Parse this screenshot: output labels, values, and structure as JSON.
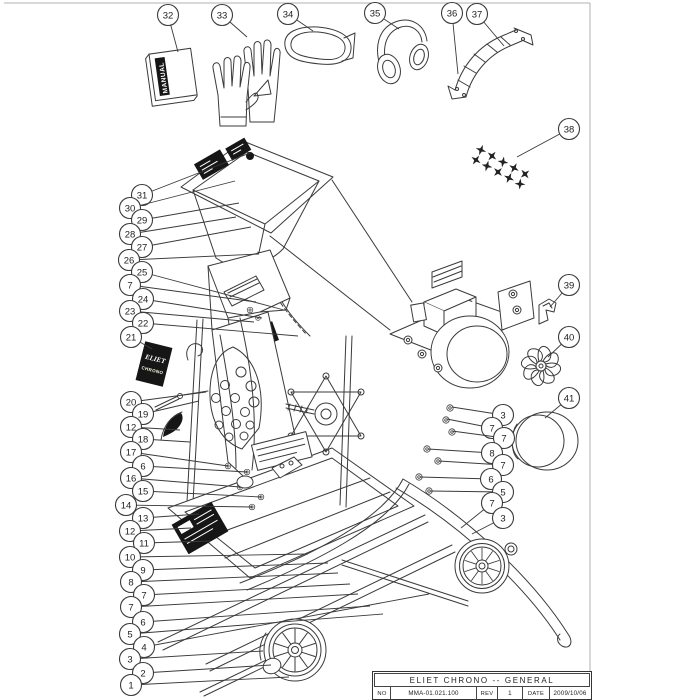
{
  "colors": {
    "line": "#3a3a3a",
    "highlight_yellow": "#f0d81e",
    "decal_black": "#161616",
    "background": "#ffffff",
    "frame_gray": "#b0b0b0"
  },
  "labels": {
    "manual": "MANUAL",
    "brand_line1": "ELIET",
    "brand_line2": "CHRONO"
  },
  "title_block": {
    "title": "ELIET CHRONO -- GENERAL",
    "no_label": "NO",
    "no_value": "MMA-01.021.100",
    "rev_label": "REV",
    "rev_value": "1",
    "date_label": "DATE",
    "date_value": "2009/10/06"
  },
  "callouts": [
    {
      "n": "32",
      "x": 168,
      "y": 15,
      "tx": 178,
      "ty": 52
    },
    {
      "n": "33",
      "x": 222,
      "y": 15,
      "tx": 247,
      "ty": 37
    },
    {
      "n": "34",
      "x": 288,
      "y": 14,
      "tx": 313,
      "ty": 31
    },
    {
      "n": "35",
      "x": 375,
      "y": 13,
      "tx": 399,
      "ty": 29
    },
    {
      "n": "36",
      "x": 452,
      "y": 13,
      "tx": 458,
      "ty": 74
    },
    {
      "n": "37",
      "x": 477,
      "y": 14,
      "tx": 504,
      "ty": 46
    },
    {
      "n": "38",
      "x": 569,
      "y": 129,
      "tx": 517,
      "ty": 157
    },
    {
      "n": "39",
      "x": 569,
      "y": 285,
      "tx": 550,
      "ty": 307
    },
    {
      "n": "40",
      "x": 569,
      "y": 337,
      "tx": 548,
      "ty": 357
    },
    {
      "n": "41",
      "x": 569,
      "y": 398,
      "tx": 545,
      "ty": 418
    },
    {
      "n": "31",
      "x": 142,
      "y": 195,
      "tx": 250,
      "ty": 153
    },
    {
      "n": "30",
      "x": 130,
      "y": 208,
      "tx": 235,
      "ty": 181
    },
    {
      "n": "29",
      "x": 142,
      "y": 220,
      "tx": 239,
      "ty": 203
    },
    {
      "n": "28",
      "x": 130,
      "y": 234,
      "tx": 236,
      "ty": 217
    },
    {
      "n": "27",
      "x": 142,
      "y": 247,
      "tx": 251,
      "ty": 227
    },
    {
      "n": "26",
      "x": 129,
      "y": 260,
      "tx": 259,
      "ty": 254
    },
    {
      "n": "25",
      "x": 142,
      "y": 272,
      "tx": 284,
      "ty": 310
    },
    {
      "n": "7",
      "x": 130,
      "y": 285,
      "tx": 256,
      "ty": 302
    },
    {
      "n": "24",
      "x": 143,
      "y": 299,
      "tx": 262,
      "ty": 318
    },
    {
      "n": "23",
      "x": 130,
      "y": 311,
      "tx": 254,
      "ty": 322
    },
    {
      "n": "22",
      "x": 143,
      "y": 323,
      "tx": 298,
      "ty": 336
    },
    {
      "n": "21",
      "x": 131,
      "y": 337,
      "tx": 152,
      "ty": 349
    },
    {
      "n": "20",
      "x": 131,
      "y": 402,
      "tx": 206,
      "ty": 392
    },
    {
      "n": "19",
      "x": 143,
      "y": 414,
      "tx": 199,
      "ty": 401
    },
    {
      "n": "12",
      "x": 131,
      "y": 427,
      "tx": 180,
      "ty": 430
    },
    {
      "n": "18",
      "x": 143,
      "y": 439,
      "tx": 190,
      "ty": 442
    },
    {
      "n": "17",
      "x": 131,
      "y": 452,
      "tx": 228,
      "ty": 466
    },
    {
      "n": "6",
      "x": 143,
      "y": 466,
      "tx": 247,
      "ty": 472
    },
    {
      "n": "16",
      "x": 131,
      "y": 478,
      "tx": 240,
      "ty": 487
    },
    {
      "n": "15",
      "x": 143,
      "y": 491,
      "tx": 261,
      "ty": 497
    },
    {
      "n": "14",
      "x": 126,
      "y": 505,
      "tx": 252,
      "ty": 507
    },
    {
      "n": "13",
      "x": 143,
      "y": 518,
      "tx": 199,
      "ty": 514
    },
    {
      "n": "12",
      "x": 130,
      "y": 531,
      "tx": 191,
      "ty": 528
    },
    {
      "n": "11",
      "x": 144,
      "y": 543,
      "tx": 211,
      "ty": 541
    },
    {
      "n": "10",
      "x": 130,
      "y": 557,
      "tx": 308,
      "ty": 554
    },
    {
      "n": "9",
      "x": 143,
      "y": 570,
      "tx": 328,
      "ty": 563
    },
    {
      "n": "8",
      "x": 131,
      "y": 582,
      "tx": 338,
      "ty": 573
    },
    {
      "n": "7",
      "x": 144,
      "y": 595,
      "tx": 350,
      "ty": 584
    },
    {
      "n": "7",
      "x": 131,
      "y": 607,
      "tx": 358,
      "ty": 594
    },
    {
      "n": "6",
      "x": 143,
      "y": 622,
      "tx": 370,
      "ty": 606
    },
    {
      "n": "5",
      "x": 130,
      "y": 634,
      "tx": 383,
      "ty": 614
    },
    {
      "n": "4",
      "x": 144,
      "y": 647,
      "tx": 429,
      "ty": 594
    },
    {
      "n": "3",
      "x": 130,
      "y": 659,
      "tx": 263,
      "ty": 651
    },
    {
      "n": "2",
      "x": 143,
      "y": 673,
      "tx": 271,
      "ty": 665
    },
    {
      "n": "1",
      "x": 131,
      "y": 685,
      "tx": 289,
      "ty": 677
    },
    {
      "n": "3",
      "x": 503,
      "y": 415,
      "tx": 452,
      "ty": 407
    },
    {
      "n": "7",
      "x": 492,
      "y": 428,
      "tx": 447,
      "ty": 419
    },
    {
      "n": "7",
      "x": 504,
      "y": 438,
      "tx": 452,
      "ty": 431
    },
    {
      "n": "8",
      "x": 492,
      "y": 453,
      "tx": 428,
      "ty": 449
    },
    {
      "n": "7",
      "x": 503,
      "y": 465,
      "tx": 439,
      "ty": 461
    },
    {
      "n": "6",
      "x": 491,
      "y": 479,
      "tx": 420,
      "ty": 477
    },
    {
      "n": "5",
      "x": 503,
      "y": 492,
      "tx": 430,
      "ty": 491
    },
    {
      "n": "7",
      "x": 492,
      "y": 503,
      "tx": 461,
      "ty": 528
    },
    {
      "n": "3",
      "x": 503,
      "y": 518,
      "tx": 472,
      "ty": 534
    }
  ]
}
